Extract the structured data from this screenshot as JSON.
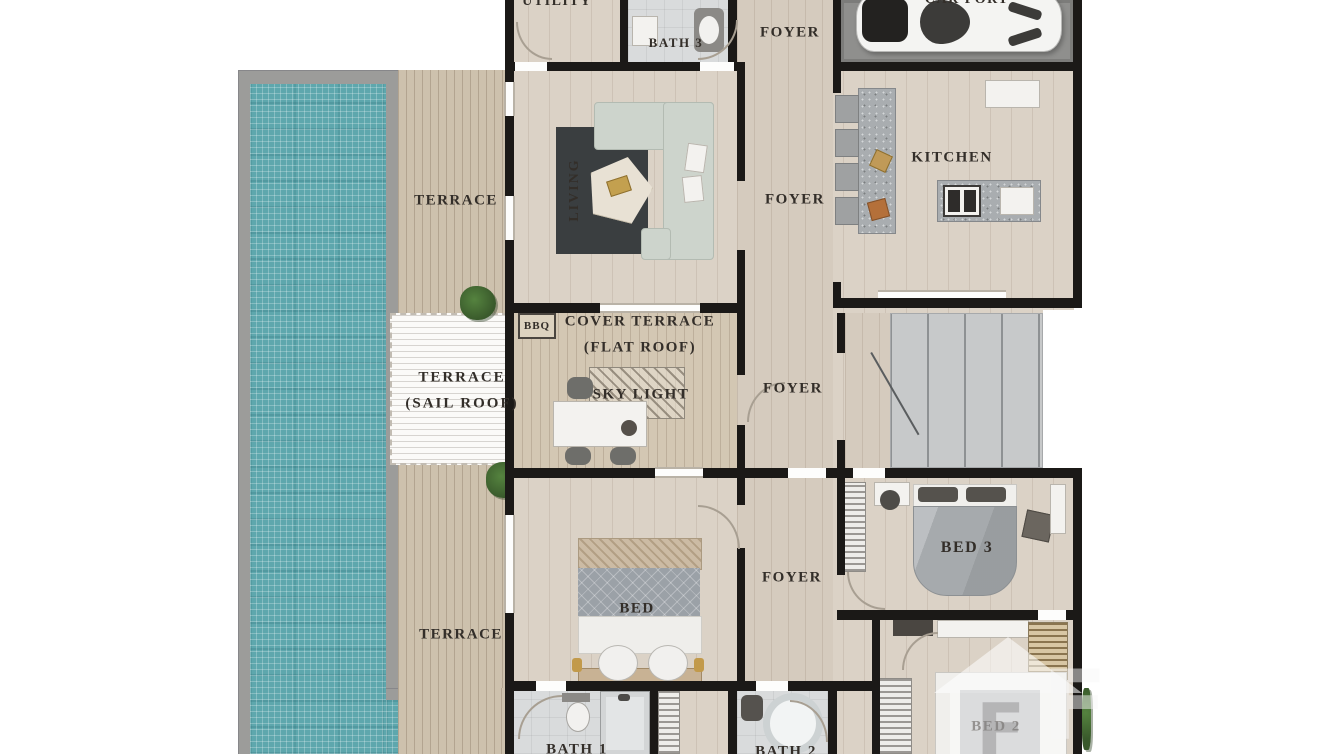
{
  "title": "Villa floor plan",
  "labels": {
    "utility": "UTILITY",
    "bath3": "BATH 3",
    "foyer_entry": "FOYER",
    "carport": "CAR PORT",
    "terrace_upper": "TERRACE",
    "living": "LIVING",
    "kitchen": "KITCHEN",
    "foyer_main": "FOYER",
    "bbq": "BBQ",
    "cover_terrace_line1": "COVER TERRACE",
    "cover_terrace_line2": "(FLAT ROOF)",
    "sky_light": "SKY LIGHT",
    "terrace_sail_line1": "TERRACE",
    "terrace_sail_line2": "(SAIL ROOF)",
    "foyer_mid": "FOYER",
    "bed_master": "BED",
    "foyer_lower": "FOYER",
    "bed3": "BED 3",
    "terrace_lower": "TERRACE",
    "bath1": "BATH 1",
    "bath2": "BATH 2",
    "bed2": "BED 2"
  },
  "watermark": {
    "f1": "F",
    "f2": "F"
  },
  "colors": {
    "wall": "#1b1917",
    "wood": "#dbd2c6",
    "deck": "#cdc1ad",
    "pool": "#5ea7ad",
    "carport": "#8f8f8d",
    "stairs": "#c7c9ca",
    "bath": "#d9dbdc",
    "rug": "#3a3e40",
    "sofa": "#cdd4cc",
    "plant": "#3f6b33",
    "label": "#332e29"
  }
}
